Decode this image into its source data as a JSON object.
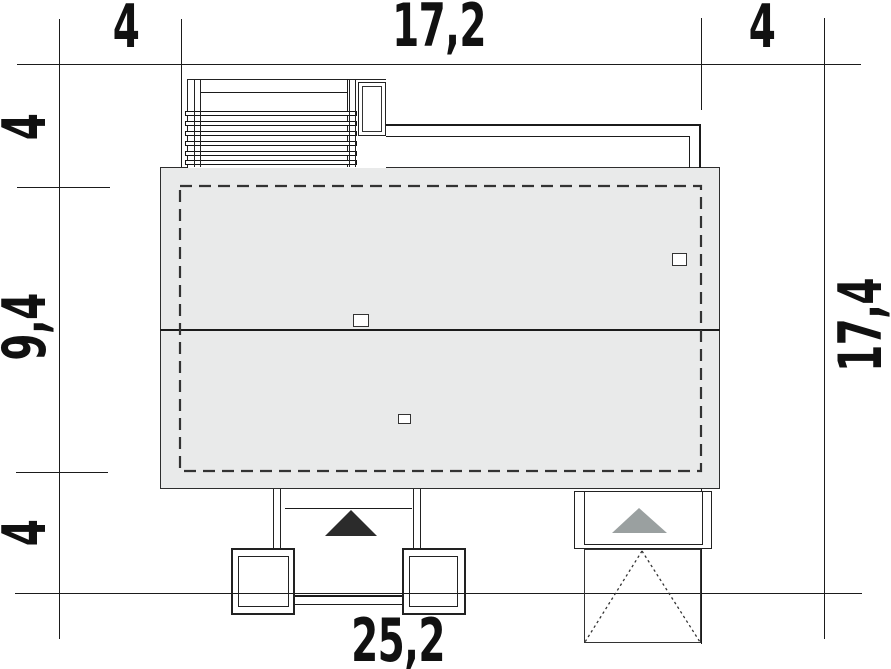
{
  "plan_type": "house site plan with overall dimensions",
  "dimensions": {
    "top_left": "4",
    "top_center": "17,2",
    "top_right": "4",
    "left_top": "4",
    "left_middle": "9,4",
    "left_bottom": "4",
    "right_side": "17,4",
    "bottom_total": "25,2"
  },
  "markers": {
    "entrance_arrow": "black-triangle-up",
    "garage_arrow": "gray-triangle-up"
  },
  "colors": {
    "background": "#ffffff",
    "line": "#1b1b1b",
    "roof_fill": "#e9eaea",
    "roof_border": "#2d2d2d",
    "dash": "#333333",
    "entrance_marker": "#2b2b2b",
    "garage_marker": "#9aa0a0"
  }
}
